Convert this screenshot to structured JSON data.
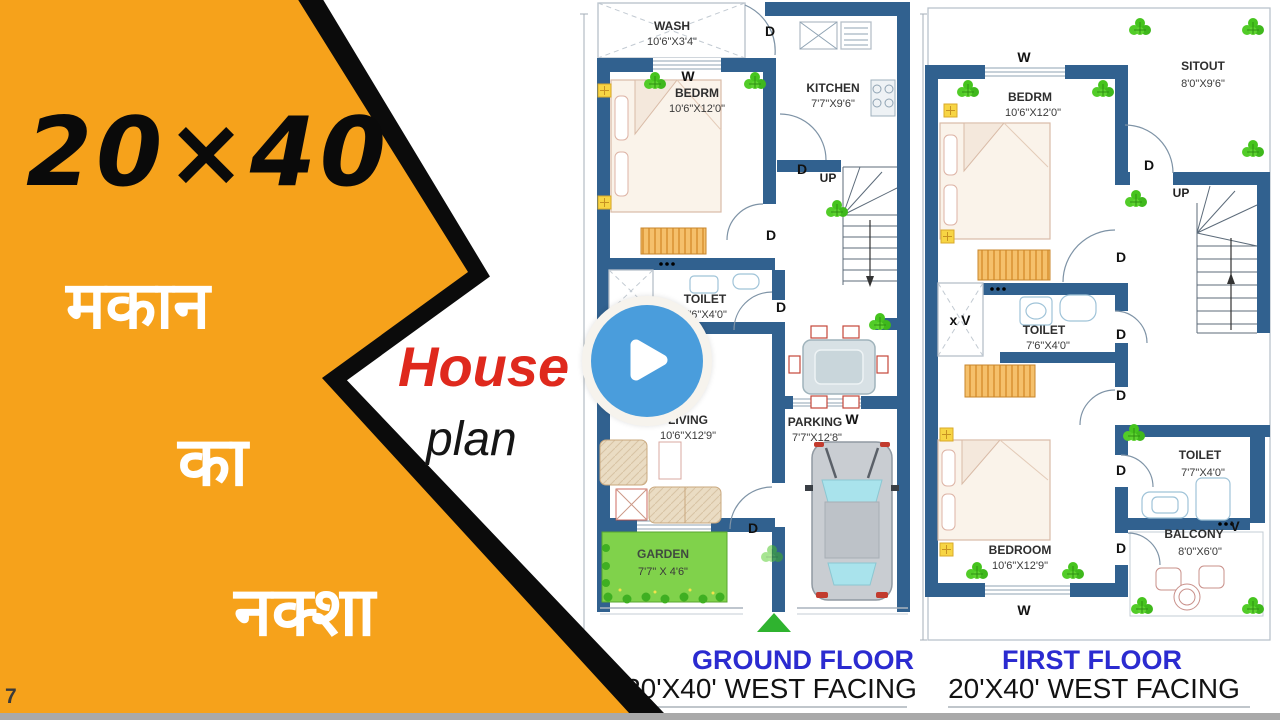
{
  "colors": {
    "banner_orange": "#F6A21B",
    "banner_border": "#0B0B0B",
    "hindi_text": "#FFFFFF",
    "accent_red": "#DF291D",
    "play_blue": "#4A9DDC",
    "play_ring": "#F6F3ED",
    "wall_blue": "#31618F",
    "caption_blue": "#2B2BD0",
    "garden_green": "#80D24B",
    "plant_green": "#46C41E"
  },
  "banner": {
    "size_label": "20×40",
    "hindi_line1": "मकान",
    "hindi_line2": "का",
    "hindi_line3": "नक्शा",
    "corner_mark": "7"
  },
  "overlay": {
    "title_accent": "House",
    "title_rest": "plan"
  },
  "plan_labels": {
    "door": "D",
    "window": "W",
    "up": "UP",
    "vent": "V",
    "vent_shaft": "x V"
  },
  "ground_floor": {
    "caption": "GROUND FLOOR",
    "subcaption": "20'X40' WEST FACING",
    "rooms": {
      "wash": {
        "name": "WASH",
        "dim": "10'6\"X3'4\""
      },
      "bedrm": {
        "name": "BEDRM",
        "dim": "10'6\"X12'0\""
      },
      "kitchen": {
        "name": "KITCHEN",
        "dim": "7'7\"X9'6\""
      },
      "toilet": {
        "name": "TOILET",
        "dim": "7'6\"X4'0\""
      },
      "living": {
        "name": "LIVING",
        "dim": "10'6\"X12'9\""
      },
      "parking": {
        "name": "PARKING",
        "dim": "7'7\"X12'8\""
      },
      "garden": {
        "name": "GARDEN",
        "dim": "7'7\" X 4'6\""
      }
    }
  },
  "first_floor": {
    "caption": "FIRST FLOOR",
    "subcaption": "20'X40' WEST FACING",
    "rooms": {
      "bedrm": {
        "name": "BEDRM",
        "dim": "10'6\"X12'0\""
      },
      "sitout": {
        "name": "SITOUT",
        "dim": "8'0\"X9'6\""
      },
      "toilet_upper": {
        "name": "TOILET",
        "dim": "7'6\"X4'0\""
      },
      "bedroom": {
        "name": "BEDROOM",
        "dim": "10'6\"X12'9\""
      },
      "toilet_lower": {
        "name": "TOILET",
        "dim": "7'7\"X4'0\""
      },
      "balcony": {
        "name": "BALCONY",
        "dim": "8'0\"X6'0\""
      }
    }
  }
}
